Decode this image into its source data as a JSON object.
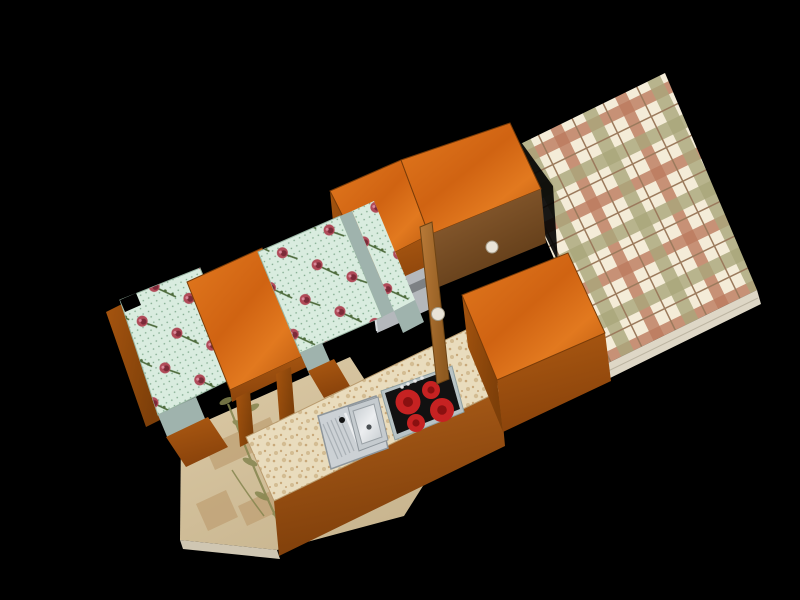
{
  "scene": {
    "title": "3D rendered kitchen interior on black background",
    "view": "overhead axonometric render, scene rotated diagonally",
    "objects": [
      {
        "label": "plaid floor mat"
      },
      {
        "label": "upper wall cabinets (wood)"
      },
      {
        "label": "refrigerator front"
      },
      {
        "label": "tall cabinet front with knob"
      },
      {
        "label": "open cabinet door with knob"
      },
      {
        "label": "corner bench with floral cushions"
      },
      {
        "label": "wooden dining table"
      },
      {
        "label": "tiled floor with plant motif"
      },
      {
        "label": "kitchen counter (stone top)"
      },
      {
        "label": "stainless sink with drainboard"
      },
      {
        "label": "ceramic cooktop with 4 red burners"
      },
      {
        "label": "base cabinet box (wood)"
      }
    ]
  },
  "colors": {
    "black": "#000000",
    "woodTopLight": "#e2791f",
    "woodTopMid": "#d06312",
    "woodTopDark": "#b5560e",
    "woodFrontLight": "#ad5a12",
    "woodFrontDark": "#8a430b",
    "woodSideLight": "#a5540f",
    "woodSideDark": "#7d3f09",
    "darkWoodLight": "#936335",
    "darkWoodDark": "#5e3a16",
    "doorLight": "#b97a38",
    "doorDark": "#8e5a20",
    "cushionBase": "#d9ecdf",
    "cushionDot": "#7fa98c",
    "cushionTrim": "#9cb8a6",
    "roseOuter": "#b04a58",
    "roseInner": "#7c2a38",
    "roseHighlight": "#d8899a",
    "stemGreen": "#4e6b3c",
    "tealEdge": "#9fb3ad",
    "floorLight": "#dccaa6",
    "floorDark": "#c9b690",
    "floorBorder": "#bfa074",
    "floorEdge": "#cfc6b2",
    "plantOlive": "#85854f",
    "plaidBase": "#f4ecd8",
    "plaidRed": "#bc7a5e",
    "plaidOlive": "#a9a67b",
    "plaidLine": "#9b7a5c",
    "plaidEdge": "#ded7c6",
    "counterBase": "#e9dcbd",
    "counterSpeck1": "#d3bc92",
    "counterSpeck2": "#c8a87a",
    "counterFrontLight": "#b0601a",
    "counterFrontDark": "#7e3e0a",
    "fridgeBody": "#b4b8bc",
    "fridgeBand": "#7d8184",
    "fridgeHandle": "#26282a",
    "fridgeGlint": "#d8dcdf",
    "steel": "#b8c3c5",
    "glass": "#111111",
    "burnerRed": "#c62222",
    "burnerCore": "#8a1010",
    "dotWhite": "#e8e8e8",
    "knobFill": "#e9e3d7",
    "knobEdge": "#a79e8b",
    "sinkTray": "#ccd1d5",
    "sinkEdge": "#8e969c",
    "sinkGroove": "#a9b0b5",
    "sinkBasin": "#c5cbcf",
    "sinkBasinLight": "#eceef0",
    "drainDark": "#4a4f53",
    "holeDark": "#141414"
  }
}
